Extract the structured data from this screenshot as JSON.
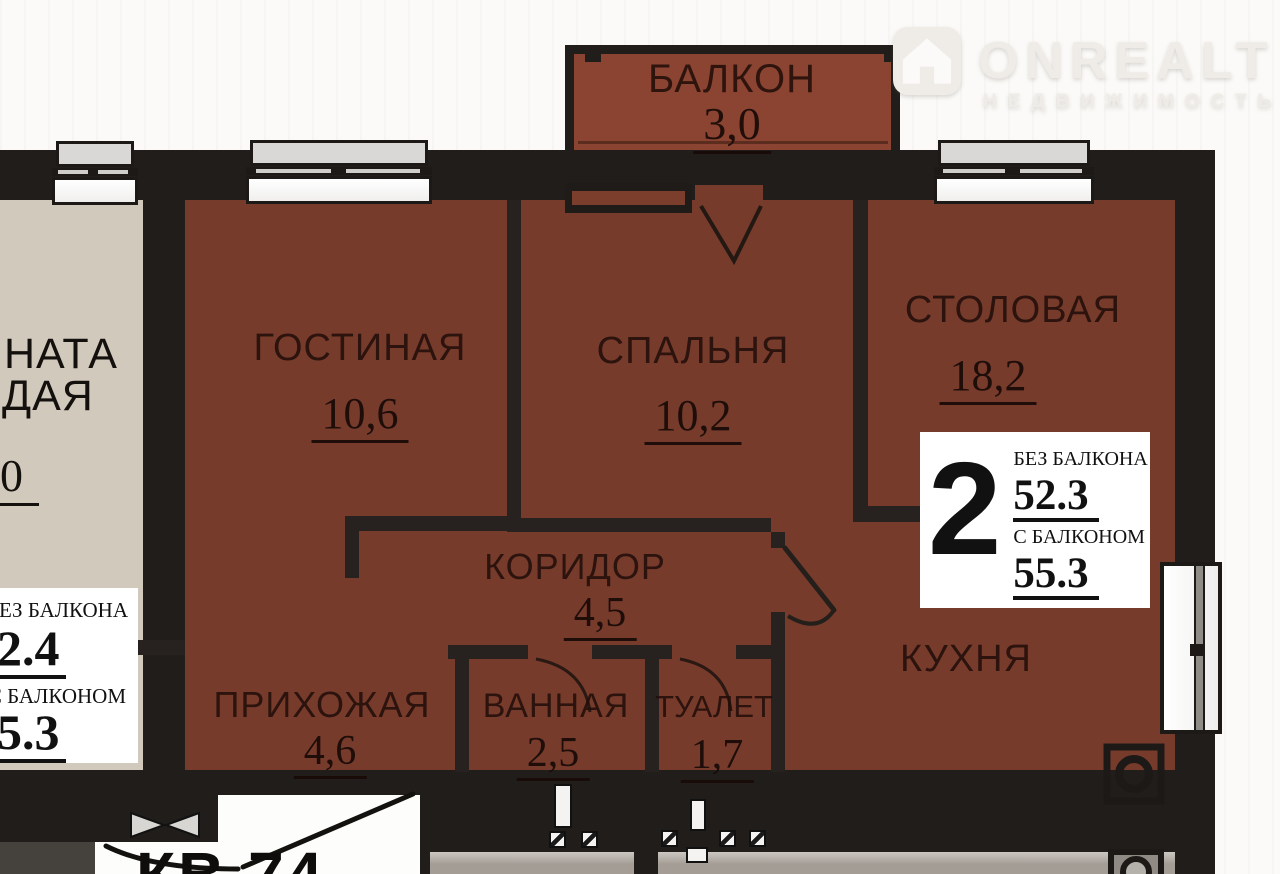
{
  "watermark": {
    "brand": "ONREALT",
    "tagline": "НЕДВИЖИМОСТЬ"
  },
  "apartment": {
    "number_label": "КВ 74",
    "rooms": {
      "balcony": {
        "label": "БАЛКОН",
        "area": "3,0"
      },
      "living": {
        "label": "ГОСТИНАЯ",
        "area": "10,6"
      },
      "bedroom": {
        "label": "СПАЛЬНЯ",
        "area": "10,2"
      },
      "dining": {
        "label": "СТОЛОВАЯ",
        "area": "18,2"
      },
      "corridor": {
        "label": "КОРИДОР",
        "area": "4,5"
      },
      "hallway": {
        "label": "ПРИХОЖАЯ",
        "area": "4,6"
      },
      "bathroom": {
        "label": "ВАННАЯ",
        "area": "2,5"
      },
      "toilet": {
        "label": "ТУАЛЕТ",
        "area": "1,7"
      },
      "kitchen": {
        "label": "КУХНЯ"
      }
    },
    "summary": {
      "rooms_count": "2",
      "no_balcony_label": "БЕЗ БАЛКОНА",
      "no_balcony_area": "52.3",
      "with_balcony_label": "С БАЛКОНОМ",
      "with_balcony_area": "55.3"
    }
  },
  "neighbor": {
    "label_fragment_line1": "НАТА",
    "label_fragment_line2": "ДАЯ",
    "area_fragment": "0",
    "box": {
      "no_balcony_label": "БЕЗ БАЛКОНА",
      "no_balcony_area": "32.4",
      "with_balcony_label": "С БАЛКОНОМ",
      "with_balcony_area": "35.3"
    }
  },
  "colors": {
    "room_fill": "#773B2C",
    "balcony_fill": "#8A4431",
    "wall": "#201D1A",
    "neighbor_fill": "#D2C9BD",
    "background": "#FBFAF8"
  }
}
